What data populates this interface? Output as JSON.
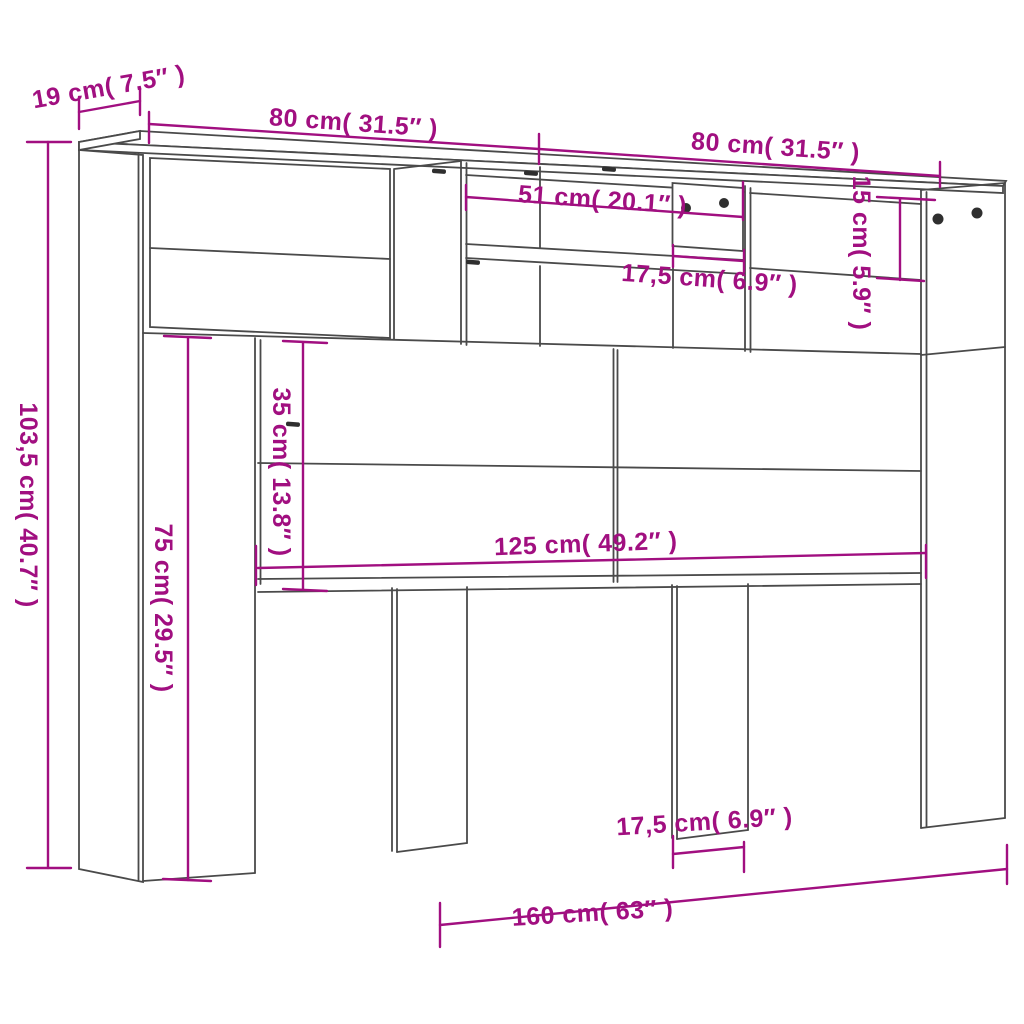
{
  "diagram": {
    "type": "furniture-dimension-drawing",
    "subject": "headboard storage cabinet",
    "colors": {
      "dimension_annotation": "#a10f80",
      "outline": "#4a4a4a",
      "knob": "#2f2f2f",
      "background": "#ffffff"
    },
    "labels": {
      "depth_top": "19 cm( 7.5″ )",
      "width_left": "80 cm( 31.5″ )",
      "width_right": "80 cm( 31.5″ )",
      "opening_width": "51 cm( 20.1″ )",
      "compartment_height": "15 cm( 5.9″ )",
      "door_width": "17,5 cm( 6.9″ )",
      "total_height": "103,5 cm( 40.7″ )",
      "niche_height": "35 cm( 13.8″ )",
      "leg_height": "75 cm( 29.5″ )",
      "niche_width": "125 cm( 49.2″ )",
      "total_width": "160 cm( 63″ )",
      "leg_depth": "17,5 cm( 6.9″ )"
    }
  }
}
